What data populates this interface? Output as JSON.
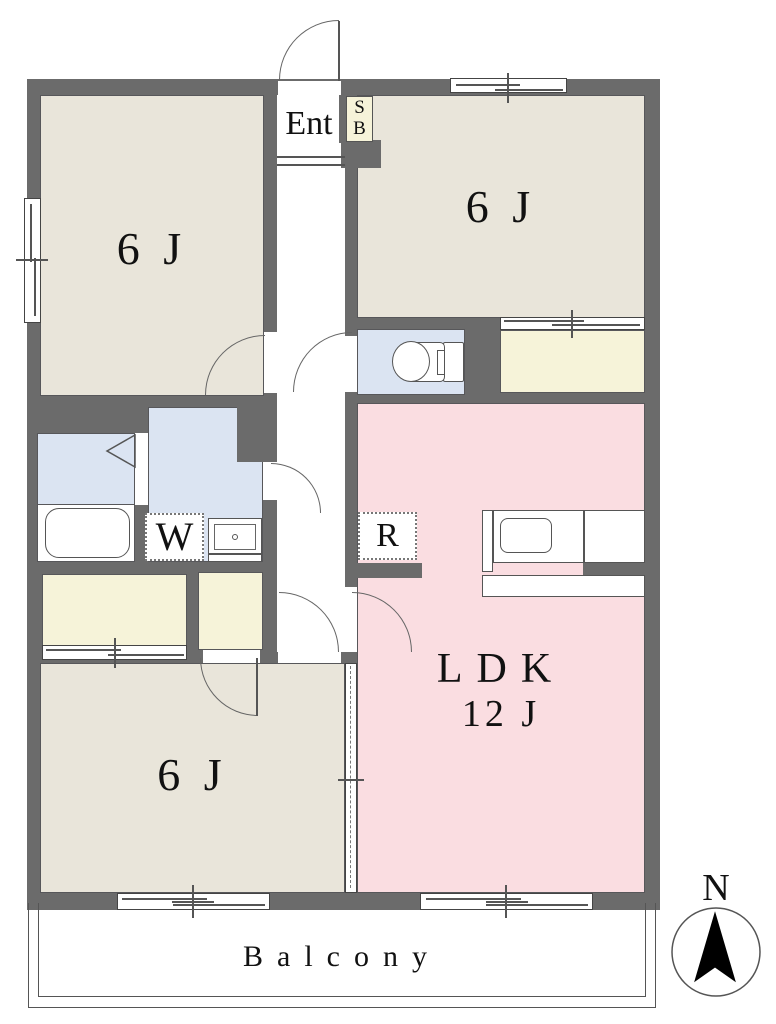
{
  "plan": {
    "type": "apartment-floor-plan",
    "rooms": {
      "bedroom_nw": {
        "label": "6 J"
      },
      "bedroom_ne": {
        "label": "6 J"
      },
      "bedroom_sw": {
        "label": "6 J"
      },
      "ldk": {
        "label": "LDK",
        "size": "12 J"
      },
      "entrance": {
        "label": "Ent"
      },
      "shoe_box": {
        "line1": "S",
        "line2": "B"
      },
      "balcony": {
        "label": "Balcony"
      }
    },
    "fixtures": {
      "washing_machine": {
        "label": "W"
      },
      "refrigerator": {
        "label": "R"
      }
    },
    "compass": {
      "label": "N"
    },
    "colors": {
      "wall": "#6b6b6b",
      "tatami_room_floor": "#e9e5da",
      "ldk_floor": "#fadde1",
      "wet_area_floor": "#dbe4f2",
      "closet_floor": "#f6f3d9",
      "line": "#555555"
    }
  }
}
